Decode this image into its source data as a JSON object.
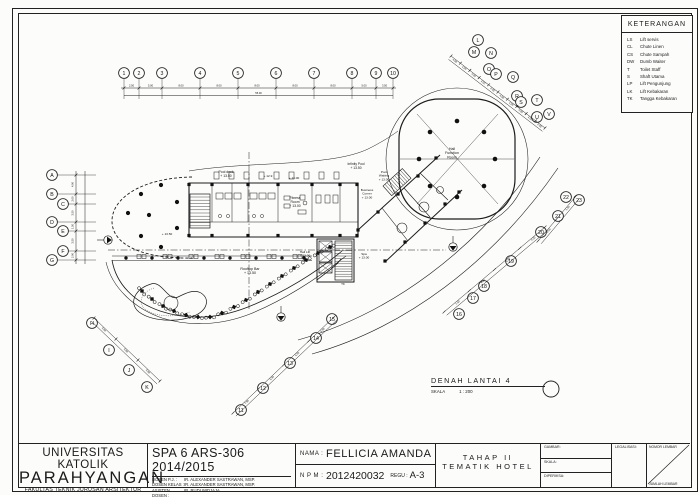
{
  "legend": {
    "title": "KETERANGAN",
    "items": [
      {
        "abbr": "LS",
        "desc": "Lift servis"
      },
      {
        "abbr": "CL",
        "desc": "Chute Linen"
      },
      {
        "abbr": "CS",
        "desc": "Chute Sampah"
      },
      {
        "abbr": "DW",
        "desc": "Dumb Waiter"
      },
      {
        "abbr": "T",
        "desc": "Toilet Staff"
      },
      {
        "abbr": "S",
        "desc": "Shaft Utama"
      },
      {
        "abbr": "LP",
        "desc": "Lift Pengunjung"
      },
      {
        "abbr": "LK",
        "desc": "Lift Kebakaran"
      },
      {
        "abbr": "TK",
        "desc": "Tangga Kebakaran"
      }
    ]
  },
  "drawing": {
    "title": "DENAH LANTAI 4",
    "scale_label": "SKALA",
    "scale_value": "1 : 200"
  },
  "plan": {
    "grid": {
      "top": [
        "1",
        "2",
        "3",
        "4",
        "5",
        "6",
        "7",
        "8",
        "9",
        "10"
      ],
      "left": [
        "A",
        "B",
        "C",
        "D",
        "E",
        "F",
        "G"
      ],
      "diagonal": [
        "L",
        "M",
        "N",
        "O",
        "P",
        "Q",
        "R",
        "S",
        "T",
        "U",
        "V"
      ],
      "right": [
        "22",
        "23",
        "21"
      ],
      "southeast": [
        "20",
        "19",
        "18",
        "17",
        "16"
      ],
      "south": [
        "15",
        "14",
        "13",
        "12",
        "11"
      ],
      "southwest": [
        "H",
        "I",
        "J",
        "K"
      ]
    },
    "labels": {
      "hall_function": {
        "lines": [
          "Hall",
          "Function",
          "Room"
        ]
      },
      "fitness": {
        "lines": [
          "Fitness",
          "Room",
          "+ 13.00"
        ]
      },
      "pool_deck": {
        "lines": [
          "Pool deck",
          "+ 13.50"
        ]
      },
      "infinity_pool": {
        "lines": [
          "Infinity Pool",
          "+ 13.50"
        ]
      },
      "pool_waiting": {
        "lines": [
          "Pool",
          "Waiting",
          "+ 13.00"
        ]
      },
      "business_corner": {
        "lines": [
          "Business",
          "Corner",
          "+ 13.00"
        ]
      },
      "rooftop_bar": {
        "lines": [
          "Rooftop Bar",
          "+ 13.50"
        ]
      },
      "hall_lift": {
        "lines": [
          "Hall Lift",
          "+ 13.00"
        ]
      },
      "spa": {
        "lines": [
          "Spa",
          "+ 13.00"
        ]
      },
      "elev_a": {
        "lines": [
          "+ 12.9"
        ]
      },
      "elev_b": {
        "lines": [
          "+ 13.00"
        ]
      },
      "elev_c": {
        "lines": [
          "+ 13.50"
        ]
      },
      "tk": {
        "lines": [
          "TK"
        ]
      }
    },
    "dimensions": {
      "top": [
        "2.50",
        "5.00",
        "8.00",
        "8.00",
        "8.00",
        "8.00",
        "8.00",
        "5.00",
        "3.50"
      ],
      "top_total": "55.00",
      "left": [
        "4.00",
        "2.00",
        "3.50",
        "1.50",
        "3.50",
        "2.00"
      ],
      "diagonal": [
        "4.00",
        "4.00",
        "4.00",
        "4.00",
        "4.00",
        "4.00",
        "4.00",
        "4.00",
        "4.00",
        "4.00"
      ],
      "right": [
        "4.00",
        "1.50"
      ],
      "southeast": [
        "1.50",
        "4.00",
        "5.00",
        "4.00"
      ],
      "south": [
        "7.50",
        "5.00",
        "5.00",
        "4.00"
      ],
      "southwest": [
        "5.00",
        "5.00",
        "5.00"
      ]
    }
  },
  "title_block": {
    "university_line1": "UNIVERSITAS KATOLIK",
    "university_line2": "PARAHYANGAN",
    "faculty": "FAKULTAS TEKNIK JURUSAN ARSITEKTUR",
    "course": "SPA 6 ARS-306 2014/2015",
    "lecturers": [
      {
        "role": "DOSEN P.J.",
        "name": "IR. ALEXANDER SASTRAWAN, MSP."
      },
      {
        "role": "DOSEN KELAS",
        "name": "IR. ALEXANDER SASTRAWAN, MSP."
      },
      {
        "role": "ASISTEN DOSEN",
        "name": "IR. RUDI WIDJAJA"
      }
    ],
    "nama_label": "NAMA :",
    "nama": "FELLICIA AMANDA",
    "npm_label": "N P M :",
    "npm": "2012420032",
    "regu_label": "REGU :",
    "regu": "A-3",
    "tahap_line1": "TAHAP II",
    "tahap_line2": "TEMATIK HOTEL",
    "fields": {
      "gambar": "GAMBAR:",
      "skala": "SKALA:",
      "diperiksa": "DIPERIKSA:",
      "legalisasi": "LEGALISASI:",
      "nomor": "NOMOR LEMBAR",
      "jumlah": "JUMLAH LEMBAR"
    }
  }
}
